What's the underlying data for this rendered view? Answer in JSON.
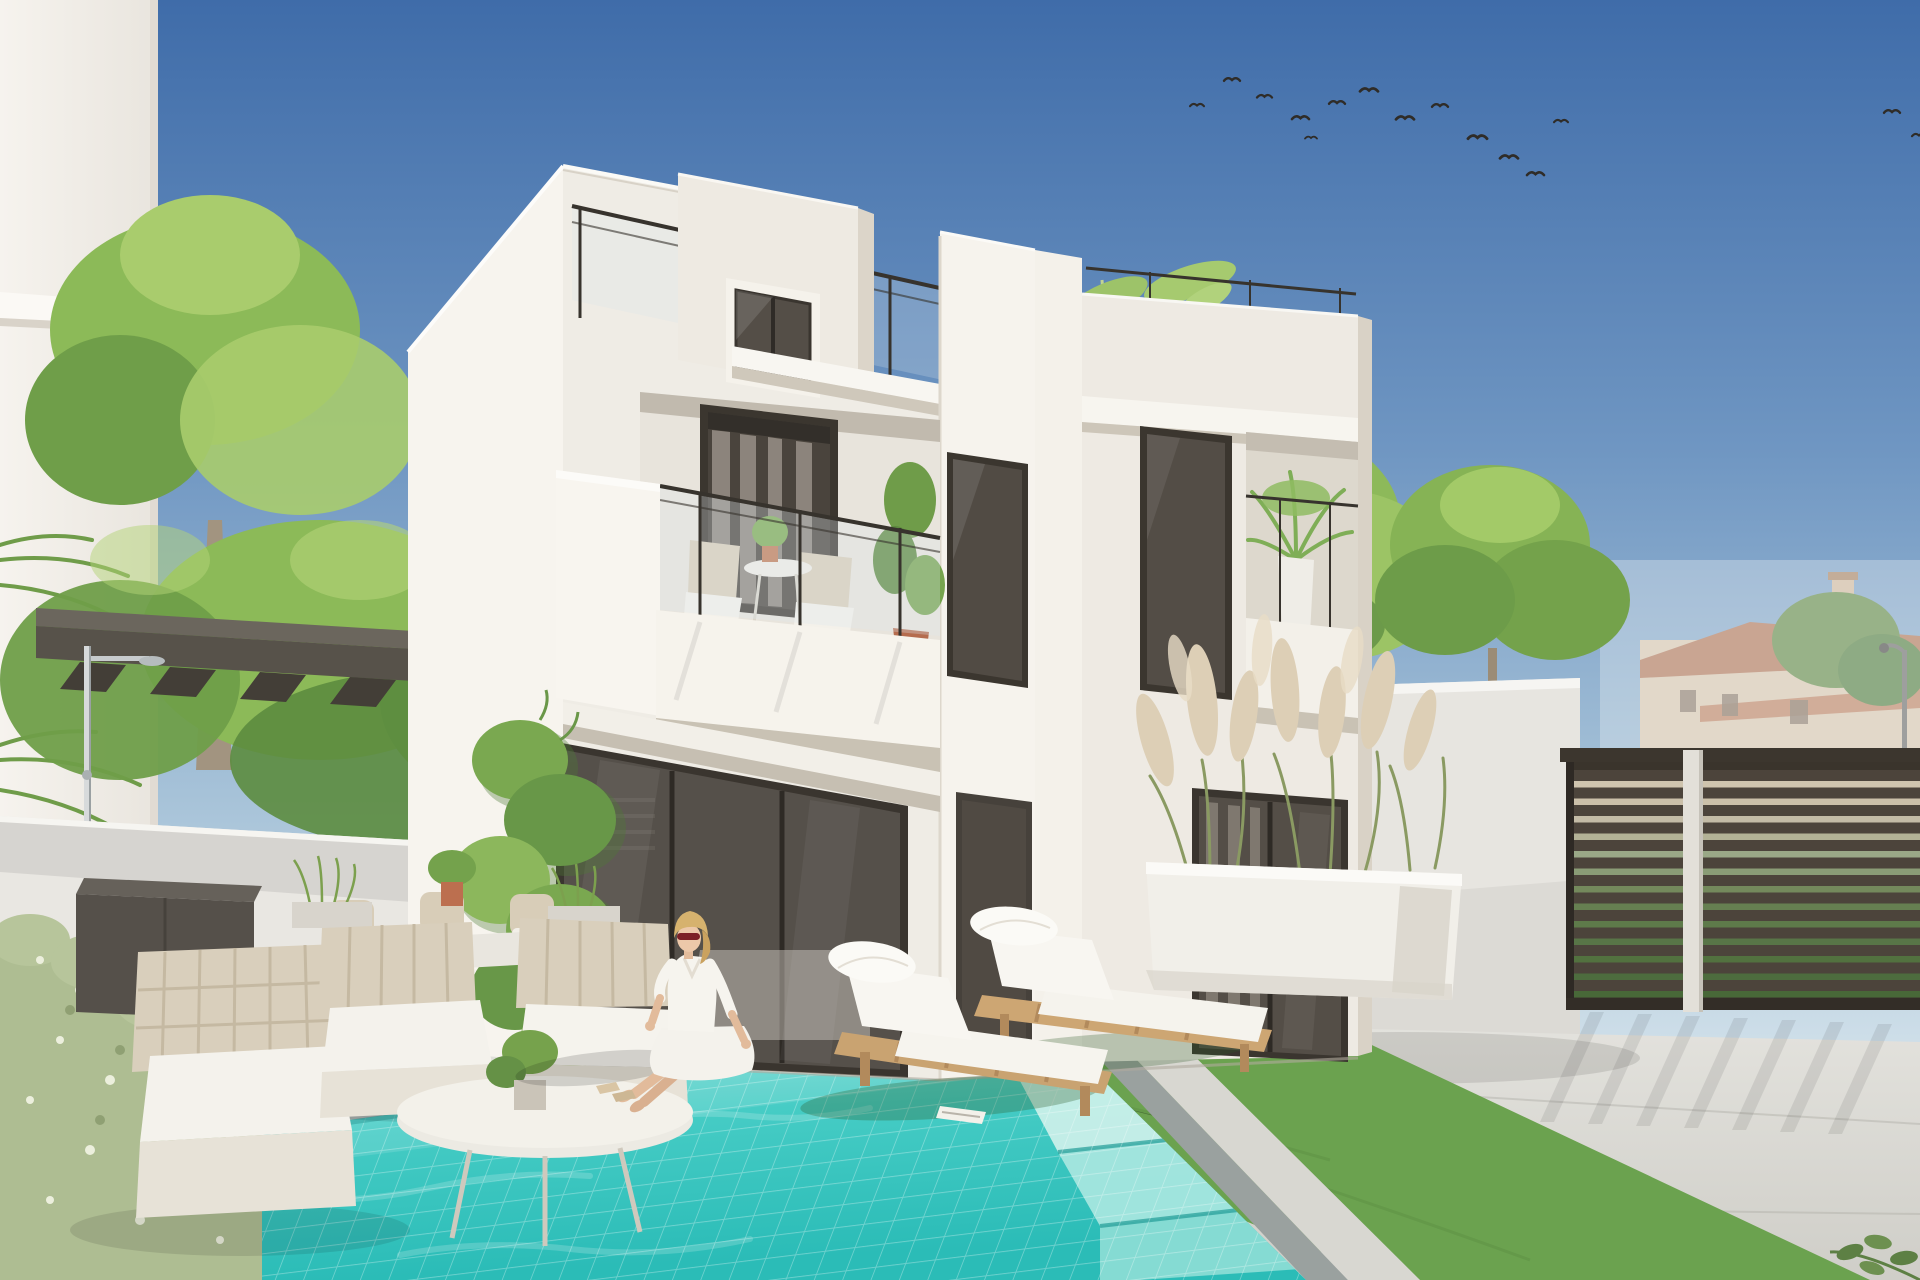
{
  "scene": {
    "type": "photorealistic-architectural-render",
    "subject": "modern two-storey white villa with rooftop terrace, private pool and landscaped patio",
    "time_of_day": "sunny daytime, clear blue sky",
    "people_count": 1,
    "counts": {
      "birds": 15,
      "sun_loungers": 2,
      "balcony_chairs": 2,
      "patio_armchairs": 3,
      "fence_slats": 13
    },
    "palette": {
      "sky_top": "#3f6ca9",
      "sky_horizon": "#e6edf1",
      "wall_sunlit": "#f7f4ee",
      "wall_shaded": "#efece5",
      "recess_shadow": "#c9c2b4",
      "glass_dark": "#534d46",
      "frame_dark": "#3a352f",
      "pool_water_far": "#8fe2da",
      "pool_water_near": "#2bbcb7",
      "pool_tile_grout": "#ffffff",
      "coping_gray": "#a8aeac",
      "pavement": "#d9d8d2",
      "grass": "#6ba24f",
      "foliage": "#8cba58",
      "pampas": "#ddcfb6",
      "wood_lounger": "#cda673",
      "cushion_white": "#f6f4ee",
      "fence_brown": "#4c443b",
      "pergola_gray": "#57524a",
      "terracotta": "#bc6f4f",
      "skin": "#e8c3a6",
      "hair_blonde": "#d6b26e",
      "sunglasses_red": "#7c2026"
    },
    "birds": [
      {
        "x": 1190,
        "y": 102,
        "s": 0.7
      },
      {
        "x": 1224,
        "y": 76,
        "s": 0.8
      },
      {
        "x": 1257,
        "y": 93,
        "s": 0.75
      },
      {
        "x": 1292,
        "y": 114,
        "s": 0.85
      },
      {
        "x": 1329,
        "y": 99,
        "s": 0.8
      },
      {
        "x": 1360,
        "y": 86,
        "s": 0.9
      },
      {
        "x": 1396,
        "y": 114,
        "s": 0.9
      },
      {
        "x": 1432,
        "y": 102,
        "s": 0.8
      },
      {
        "x": 1468,
        "y": 133,
        "s": 0.95
      },
      {
        "x": 1500,
        "y": 153,
        "s": 0.9
      },
      {
        "x": 1527,
        "y": 170,
        "s": 0.85
      },
      {
        "x": 1554,
        "y": 118,
        "s": 0.7
      },
      {
        "x": 1305,
        "y": 135,
        "s": 0.6
      },
      {
        "x": 1884,
        "y": 108,
        "s": 0.8
      },
      {
        "x": 1912,
        "y": 132,
        "s": 0.7
      }
    ],
    "fence": {
      "x": 1572,
      "width": 348,
      "top": 770,
      "slat_height": 11,
      "step": 17.5,
      "count": 13,
      "slat_color": "#4c443b",
      "gap_colors": [
        "#cfc4ae",
        "#cbc0a9",
        "#c3bba6",
        "#b3b296",
        "#9aa887",
        "#8a9c76",
        "#74895c",
        "#667f51",
        "#5e7a4a",
        "#587547",
        "#52713f",
        "#4d6c3e",
        "#486838"
      ]
    },
    "elements": [
      {
        "name": "sky",
        "region": [
          0,
          0,
          1920,
          700
        ]
      },
      {
        "name": "bird-flock",
        "region": [
          1180,
          55,
          760,
          130
        ]
      },
      {
        "name": "neighbour-building-left",
        "region": [
          0,
          0,
          158,
          980
        ]
      },
      {
        "name": "background-houses",
        "region": [
          1600,
          560,
          320,
          220
        ]
      },
      {
        "name": "street-lamp",
        "region": [
          1884,
          640,
          30,
          130
        ]
      },
      {
        "name": "trees-left",
        "region": [
          30,
          215,
          640,
          620
        ]
      },
      {
        "name": "trees-right",
        "region": [
          1070,
          410,
          560,
          300
        ]
      },
      {
        "name": "bamboo-roof-terrace",
        "region": [
          1070,
          255,
          190,
          275
        ]
      },
      {
        "name": "main-house",
        "region": [
          408,
          166,
          966,
          914
        ]
      },
      {
        "name": "stair-bulkhead-window",
        "region": [
          726,
          278,
          94,
          120
        ]
      },
      {
        "name": "roof-terrace-glass-railing",
        "region": [
          572,
          206,
          556,
          214
        ]
      },
      {
        "name": "first-floor-balcony",
        "region": [
          556,
          392,
          384,
          380
        ]
      },
      {
        "name": "right-wing-balcony-palm",
        "region": [
          1246,
          432,
          112,
          286
        ]
      },
      {
        "name": "sliding-glass-doors",
        "region": [
          556,
          742,
          352,
          336
        ]
      },
      {
        "name": "front-door",
        "region": [
          956,
          792,
          76,
          282
        ]
      },
      {
        "name": "wing-sliding-doors",
        "region": [
          1192,
          788,
          156,
          274
        ]
      },
      {
        "name": "climbing-vine",
        "region": [
          455,
          700,
          175,
          390
        ]
      },
      {
        "name": "pergola-canopy",
        "region": [
          36,
          608,
          624,
          88
        ]
      },
      {
        "name": "outdoor-shower",
        "region": [
          84,
          646,
          80,
          262
        ]
      },
      {
        "name": "garden-wall-left",
        "region": [
          0,
          816,
          412,
          192
        ]
      },
      {
        "name": "garden-wall-right",
        "region": [
          1330,
          678,
          250,
          370
        ]
      },
      {
        "name": "slat-fence",
        "region": [
          1560,
          748,
          360,
          262
        ]
      },
      {
        "name": "pampas-planter",
        "region": [
          1120,
          630,
          360,
          370
        ]
      },
      {
        "name": "patio-lounge-set",
        "region": [
          76,
          878,
          620,
          370
        ]
      },
      {
        "name": "dining-set",
        "region": [
          300,
          860,
          320,
          120
        ]
      },
      {
        "name": "storage-cabinet",
        "region": [
          76,
          878,
          186,
          142
        ]
      },
      {
        "name": "hedge",
        "region": [
          0,
          926,
          262,
          354
        ]
      },
      {
        "name": "pool",
        "region": [
          0,
          1002,
          1420,
          278
        ]
      },
      {
        "name": "pool-steps",
        "region": [
          1012,
          1040,
          392,
          240
        ]
      },
      {
        "name": "woman-sitting-poolside",
        "region": [
          596,
          905,
          160,
          210
        ]
      },
      {
        "name": "sun-loungers",
        "region": [
          820,
          893,
          465,
          215
        ]
      },
      {
        "name": "artificial-grass-strip",
        "region": [
          740,
          962,
          1130,
          318
        ]
      },
      {
        "name": "stone-pavement",
        "region": [
          0,
          998,
          1920,
          282
        ]
      }
    ]
  }
}
